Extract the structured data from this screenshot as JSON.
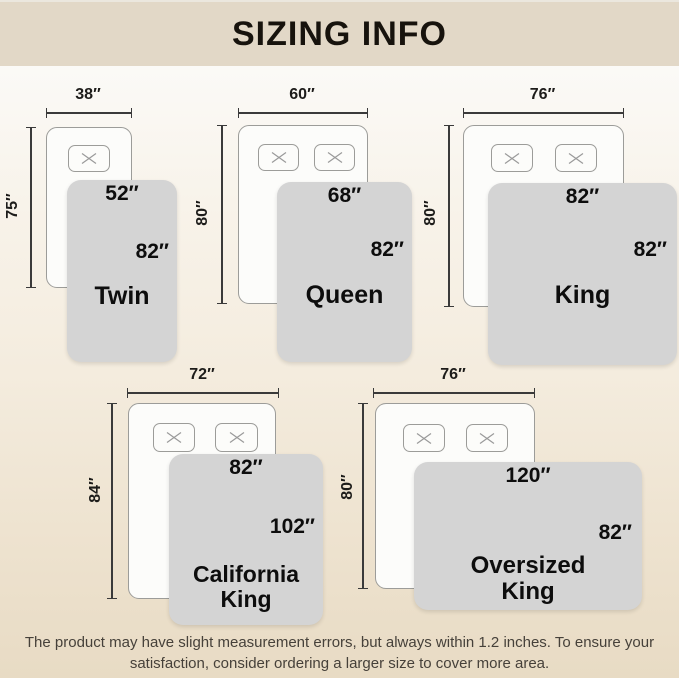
{
  "header": {
    "title": "SIZING INFO"
  },
  "sizes": [
    {
      "name": "Twin",
      "name_lines": [
        "Twin"
      ],
      "mattress_width": "38″",
      "mattress_length": "75″",
      "blanket_width": "52″",
      "blanket_length": "82″",
      "pillow_count": 1
    },
    {
      "name": "Queen",
      "name_lines": [
        "Queen"
      ],
      "mattress_width": "60″",
      "mattress_length": "80″",
      "blanket_width": "68″",
      "blanket_length": "82″",
      "pillow_count": 2
    },
    {
      "name": "King",
      "name_lines": [
        "King"
      ],
      "mattress_width": "76″",
      "mattress_length": "80″",
      "blanket_width": "82″",
      "blanket_length": "82″",
      "pillow_count": 2
    },
    {
      "name": "California King",
      "name_lines": [
        "California",
        "King"
      ],
      "mattress_width": "72″",
      "mattress_length": "84″",
      "blanket_width": "82″",
      "blanket_length": "102″",
      "pillow_count": 2
    },
    {
      "name": "Oversized King",
      "name_lines": [
        "Oversized",
        "King"
      ],
      "mattress_width": "76″",
      "mattress_length": "80″",
      "blanket_width": "120″",
      "blanket_length": "82″",
      "pillow_count": 2
    }
  ],
  "footer": {
    "line1": "The product may have slight measurement errors, but always within 1.2 inches. To ensure your",
    "line2": "satisfaction, consider ordering a larger size to cover more area."
  },
  "colors": {
    "header_bg": "#e2d8c7",
    "blanket_gray": "#d4d4d4",
    "bed_outline": "#9c9c99",
    "dimension_line": "#3a3a3a",
    "footer_text": "#46413a"
  }
}
